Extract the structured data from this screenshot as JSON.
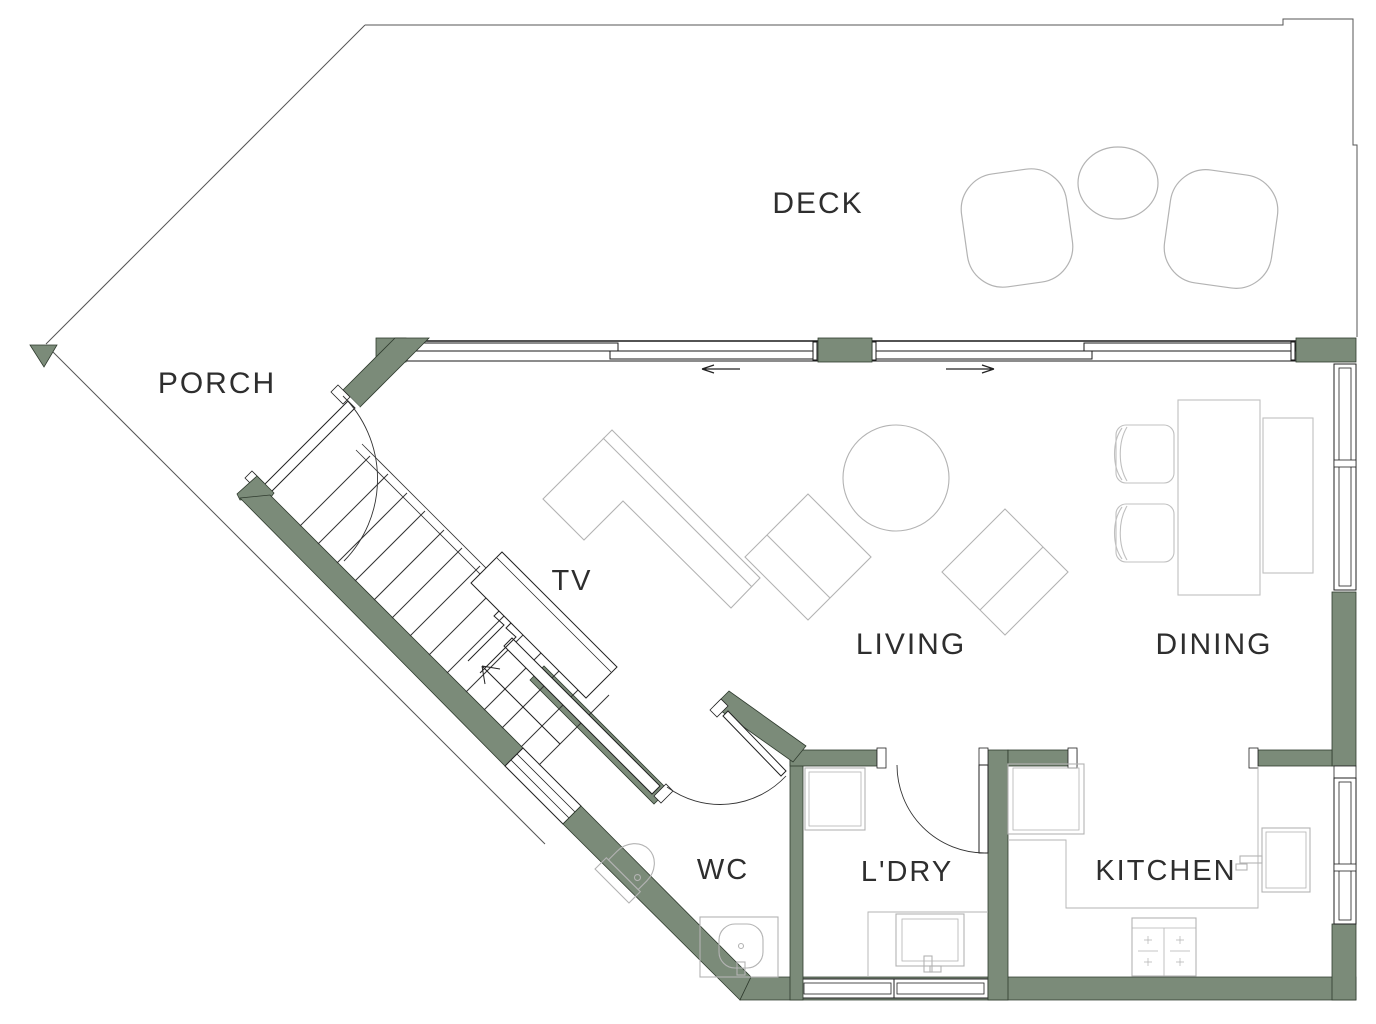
{
  "drawing": {
    "type": "architectural floor plan",
    "level": "main floor"
  },
  "colors": {
    "wall_fill": "#7b8b79",
    "wall_outline": "#2f3b2e",
    "drawing_line": "#2a2a2a",
    "furniture_line": "#b3b3b3",
    "outline_line": "#555555",
    "background": "#ffffff"
  },
  "rooms": [
    {
      "id": "deck",
      "label": "DECK"
    },
    {
      "id": "porch",
      "label": "PORCH"
    },
    {
      "id": "tv",
      "label": "TV"
    },
    {
      "id": "living",
      "label": "LIVING"
    },
    {
      "id": "dining",
      "label": "DINING"
    },
    {
      "id": "wc",
      "label": "WC"
    },
    {
      "id": "ldry",
      "label": "L'DRY"
    },
    {
      "id": "kitchen",
      "label": "KITCHEN"
    }
  ],
  "symbols": [
    {
      "name": "slide-left-arrow",
      "meaning": "sliding door opens left"
    },
    {
      "name": "slide-right-arrow",
      "meaning": "sliding door opens right"
    },
    {
      "name": "door-swing-arc",
      "meaning": "hinged door swing"
    },
    {
      "name": "stair-break-line",
      "meaning": "stair run continues below"
    }
  ],
  "furniture": [
    "deck lounge chairs",
    "deck round table",
    "sofa-l-shape",
    "armchairs",
    "round coffee table",
    "tv cabinet",
    "dining table",
    "dining chairs",
    "sideboard",
    "toilet",
    "wc basin",
    "washer",
    "laundry sink",
    "fridge",
    "kitchen sink",
    "cooktop",
    "staircase"
  ]
}
